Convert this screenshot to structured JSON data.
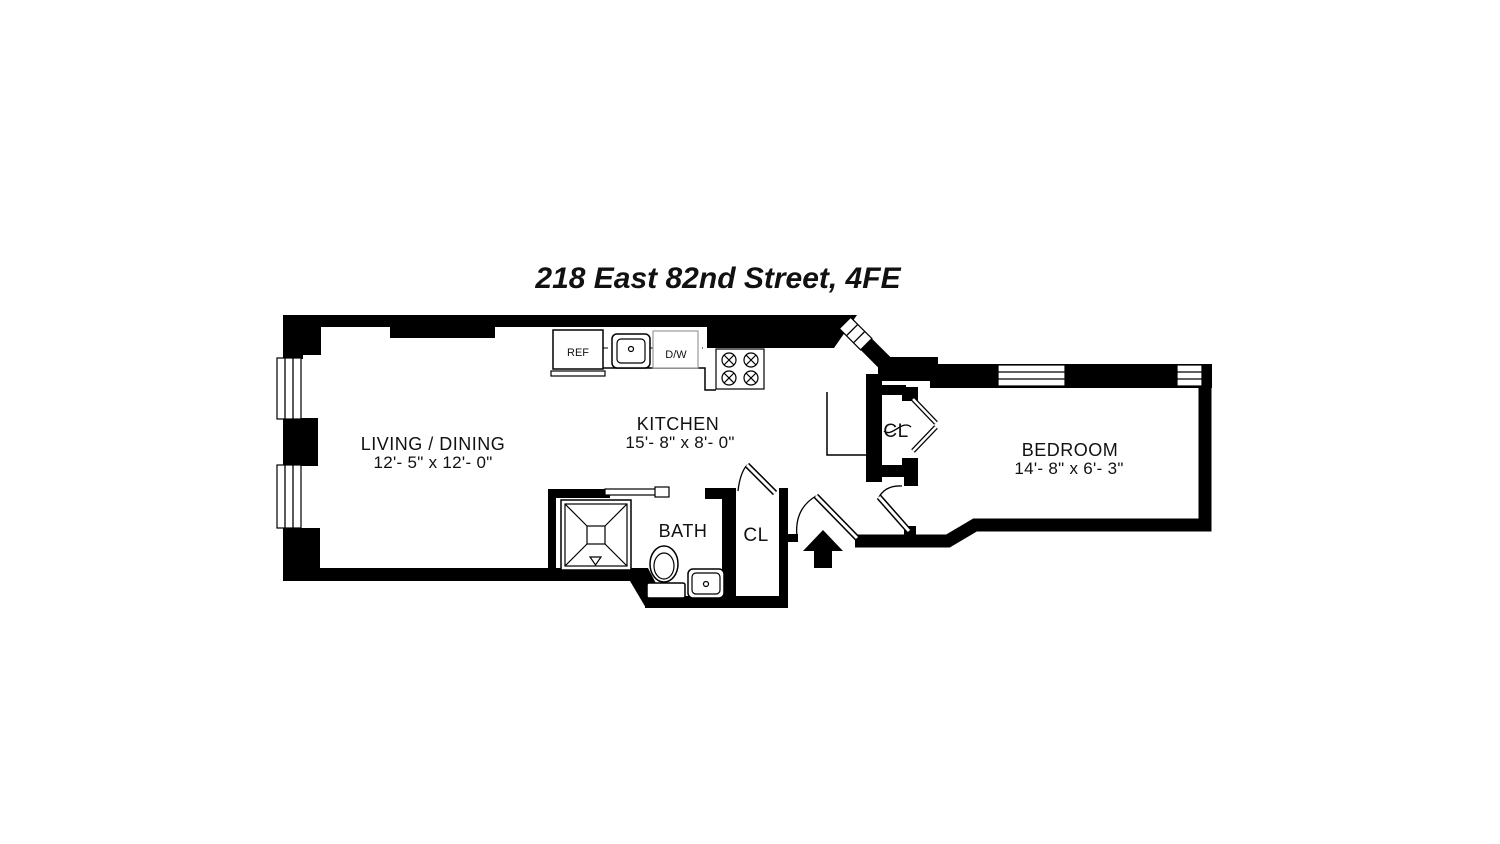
{
  "title": "218 East 82nd Street, 4FE",
  "rooms": {
    "living": {
      "label": "LIVING / DINING",
      "dims": "12'- 5\" x 12'- 0\""
    },
    "kitchen": {
      "label": "KITCHEN",
      "dims": "15'- 8\" x 8'- 0\""
    },
    "bath": {
      "label": "BATH"
    },
    "bath_closet": {
      "label": "CL"
    },
    "bedroom_closet": {
      "label": "CL"
    },
    "bedroom": {
      "label": "BEDROOM",
      "dims": "14'- 8\" x 6'- 3\""
    }
  },
  "appliances": {
    "refrigerator": {
      "label": "REF"
    },
    "dishwasher": {
      "label": "D/W"
    }
  },
  "colors": {
    "wall": "#000000",
    "background": "#ffffff"
  }
}
